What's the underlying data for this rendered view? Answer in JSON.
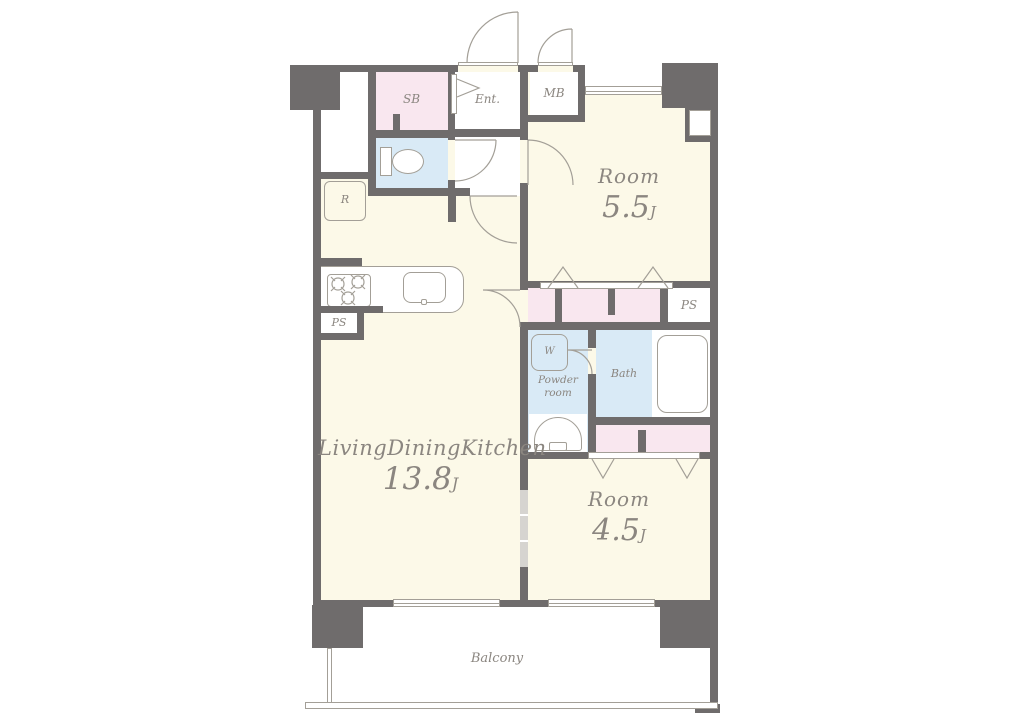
{
  "title": "apartment-floor-plan",
  "labels": {
    "sb": "SB",
    "ent": "Ent.",
    "mb": "MB",
    "r": "R",
    "ps_left": "PS",
    "ps_right": "PS",
    "w": "W",
    "powder_1": "Powder",
    "powder_2": "room",
    "bath": "Bath",
    "room_top_name": "Room",
    "room_top_size": "5.5",
    "room_top_unit": "J",
    "ldk_name": "LivingDiningKitchen",
    "ldk_size": "13.8",
    "ldk_unit": "J",
    "room_bottom_name": "Room",
    "room_bottom_size": "4.5",
    "room_bottom_unit": "J",
    "balcony": "Balcony"
  },
  "colors": {
    "wall": "#6f6c6c",
    "room_fill": "#fcf9e8",
    "closet_fill": "#f9e7ef",
    "wet_fill": "#d9eaf6",
    "outline": "#a39f97",
    "label": "#8b8680"
  }
}
